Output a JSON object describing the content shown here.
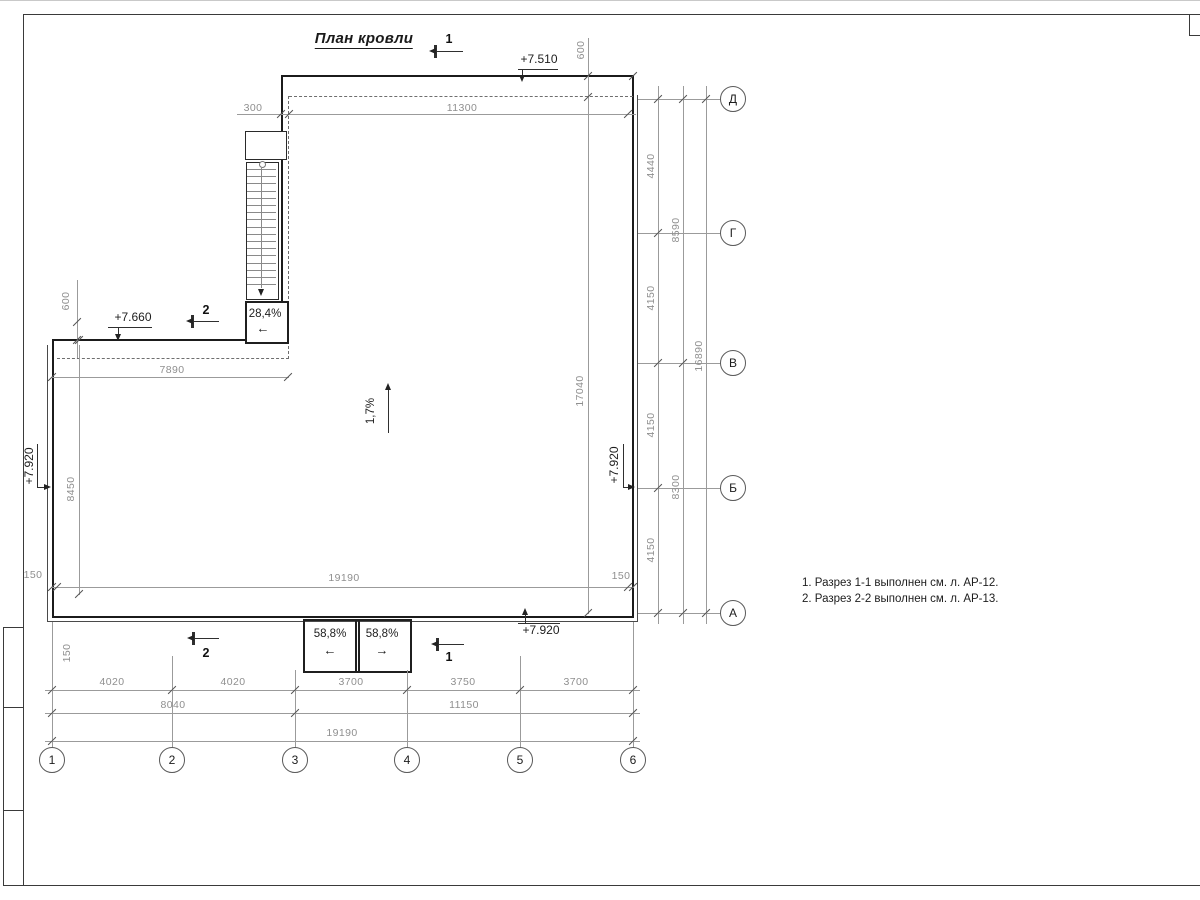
{
  "drawing": {
    "title": "План кровли",
    "notes": [
      "1. Разрез 1-1 выполнен см. л. АР-12.",
      "2. Разрез 2-2 выполнен см. л. АР-13."
    ]
  },
  "elevations": {
    "roof_high": "+7.510",
    "wing": "+7.660",
    "left_wall": "+7.920",
    "right_wall": "+7.920",
    "bottom_wall": "+7.920"
  },
  "slopes": {
    "stair_ramp": "28,4%",
    "main_roof": "1,7%",
    "canopy_left": "58,8%",
    "canopy_right": "58,8%"
  },
  "icons": {
    "arrow_left": "←",
    "arrow_right": "→"
  },
  "section_marks": {
    "top": "1",
    "wing": "2",
    "bottom_left": "2",
    "bottom_right": "1"
  },
  "dims": {
    "top": {
      "d300": "300",
      "d11300": "11300",
      "offset600": "600"
    },
    "left": {
      "offset600": "600",
      "d7890": "7890",
      "d8450": "8450",
      "d150a": "150",
      "d150b": "150"
    },
    "bottom_edge": {
      "d150l": "150",
      "d19190": "19190",
      "d150r": "150"
    },
    "inner": {
      "d17040": "17040"
    },
    "right": {
      "c1": [
        "4440",
        "4150",
        "4150",
        "4150"
      ],
      "c2": [
        "8590",
        "8300"
      ],
      "c3": "16890"
    },
    "bottom": {
      "c1": [
        "4020",
        "4020",
        "3700",
        "3750",
        "3700"
      ],
      "c2": [
        "8040",
        "11150"
      ],
      "c3": "19190"
    }
  },
  "axes": {
    "horizontal": [
      "1",
      "2",
      "3",
      "4",
      "5",
      "6"
    ],
    "vertical": [
      "Д",
      "Г",
      "В",
      "Б",
      "А"
    ]
  }
}
